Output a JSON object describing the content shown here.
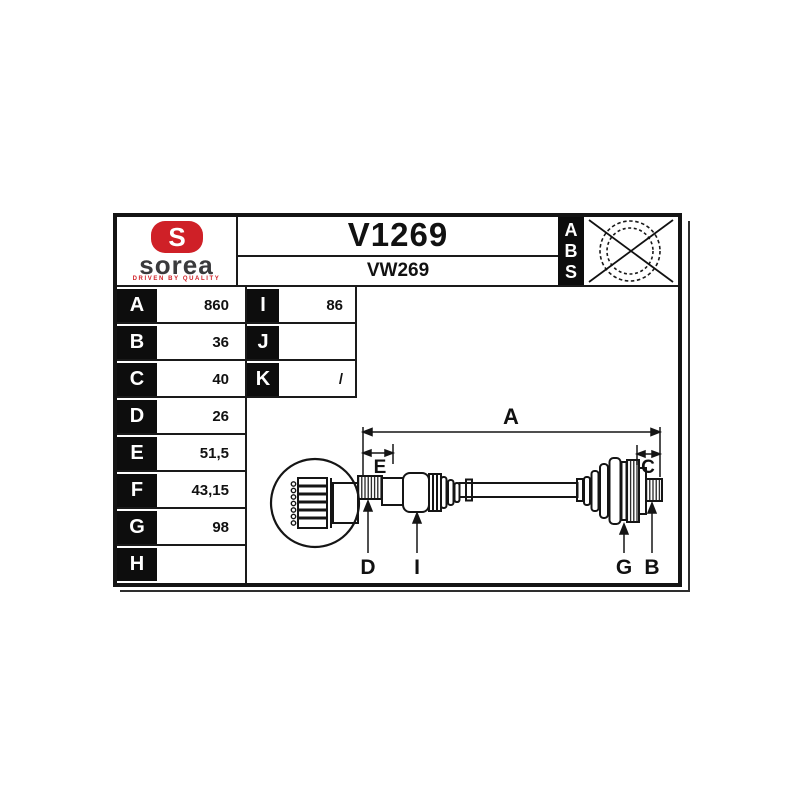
{
  "brand": {
    "logo_text": "sorea",
    "tagline": "DRIVEN BY QUALITY",
    "emblem_letter": "S",
    "red": "#cf2027",
    "dark_gray": "#3a3a3c"
  },
  "header": {
    "part_number": "V1269",
    "reference": "VW269"
  },
  "abs": {
    "letters": [
      "A",
      "B",
      "S"
    ],
    "crossed_out": true
  },
  "specs": {
    "left": [
      {
        "key": "A",
        "value": "860"
      },
      {
        "key": "B",
        "value": "36"
      },
      {
        "key": "C",
        "value": "40"
      },
      {
        "key": "D",
        "value": "26"
      },
      {
        "key": "E",
        "value": "51,5"
      },
      {
        "key": "F",
        "value": "43,15"
      },
      {
        "key": "G",
        "value": "98"
      },
      {
        "key": "H",
        "value": ""
      }
    ],
    "right": [
      {
        "key": "I",
        "value": "86"
      },
      {
        "key": "J",
        "value": ""
      },
      {
        "key": "K",
        "value": "/"
      }
    ]
  },
  "diagram": {
    "labels": {
      "a": "A",
      "e": "E",
      "c": "C",
      "d": "D",
      "i": "I",
      "g": "G",
      "b": "B"
    }
  }
}
